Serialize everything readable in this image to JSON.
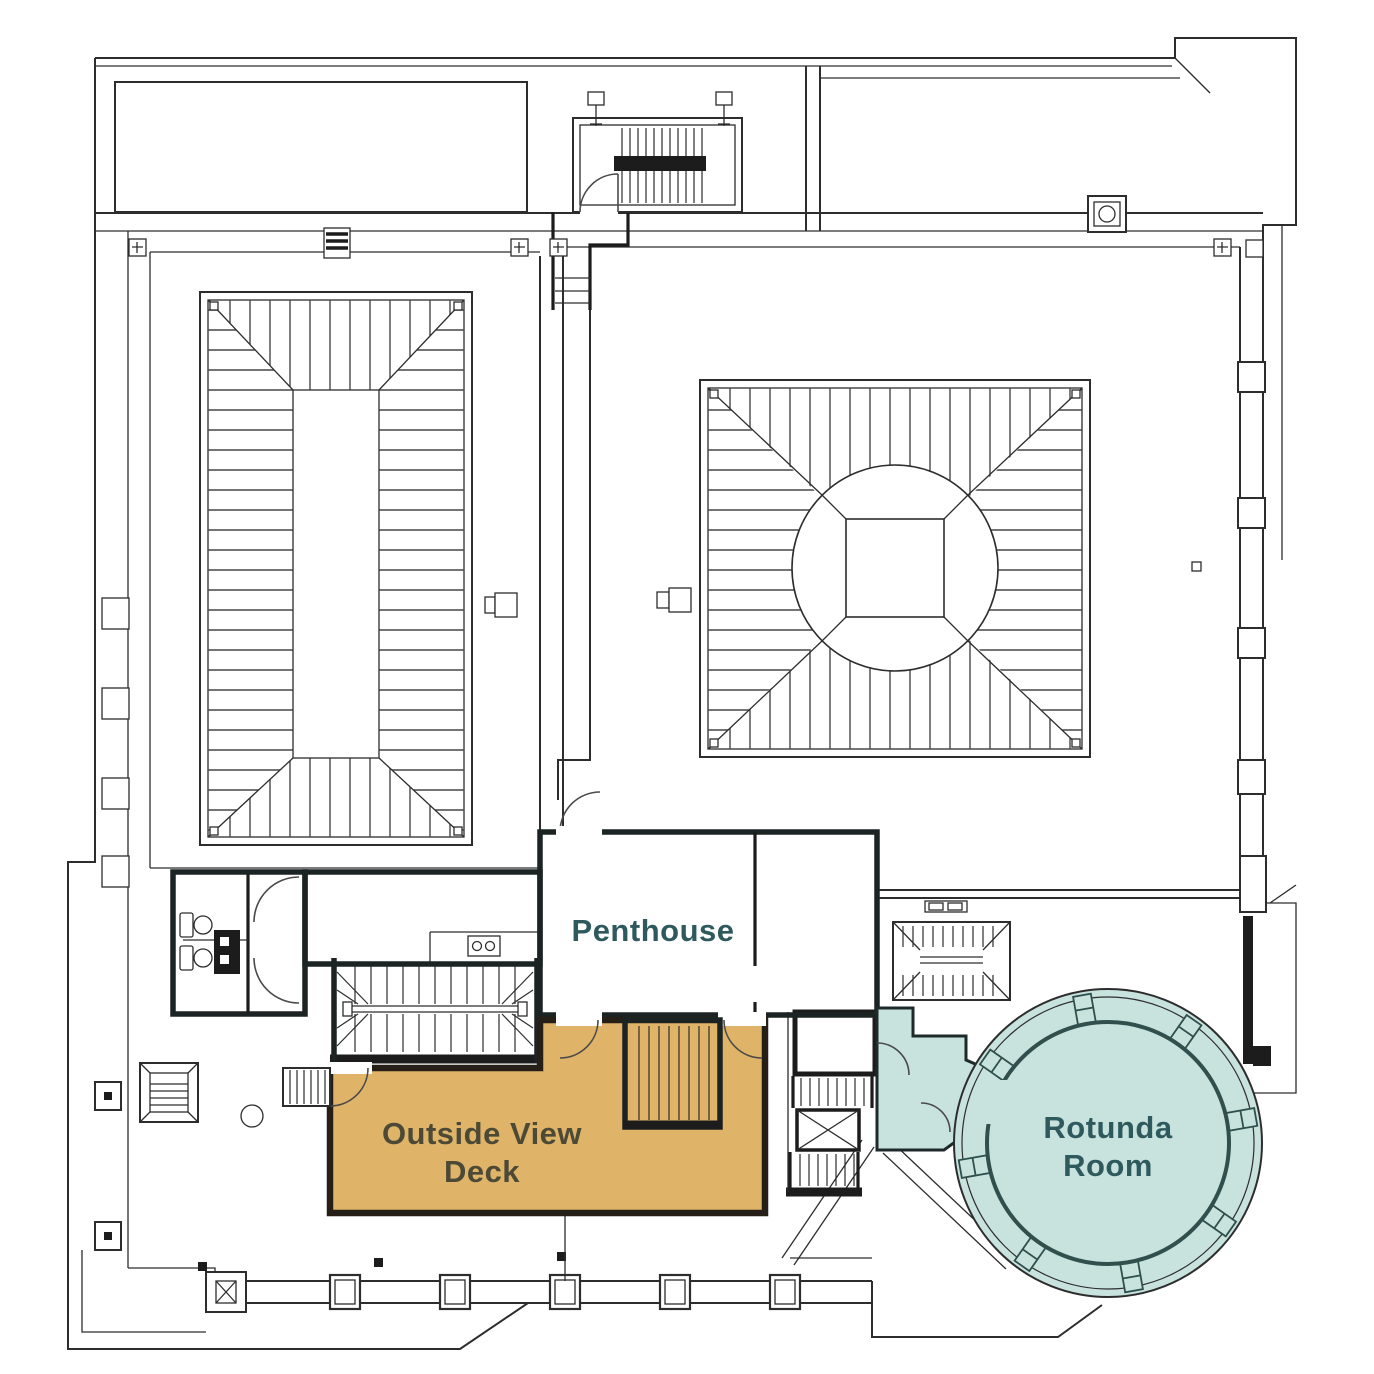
{
  "plan": {
    "rooms": {
      "penthouse": {
        "label": "Penthouse"
      },
      "outside_view_deck": {
        "label": "Outside View Deck",
        "label_lines": [
          "Outside View",
          "Deck"
        ]
      },
      "rotunda_room": {
        "label": "Rotunda Room",
        "label_lines": [
          "Rotunda",
          "Room"
        ]
      }
    },
    "colors": {
      "background": "#ffffff",
      "wall": "#2d2d2d",
      "wall_dark": "#1c1c1c",
      "room_teal": "#c8e2dd",
      "room_tan": "#dfb469",
      "label_teal": "#2e5a5e",
      "label_deck": "#4c4936"
    }
  }
}
